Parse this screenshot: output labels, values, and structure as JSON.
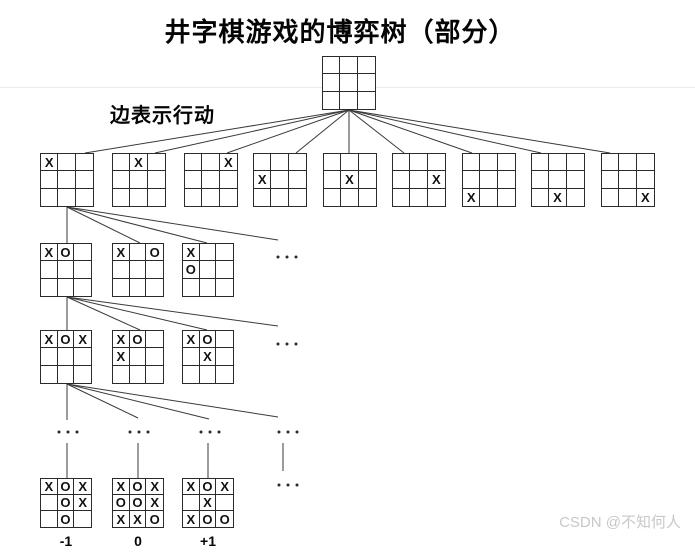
{
  "title": "井字棋游戏的博弈树（部分）",
  "edge_label": "边表示行动",
  "watermark": "CSDN @不知何人",
  "colors": {
    "background": "#ffffff",
    "line": "#3a3a3a",
    "board_border": "#2b2b2b",
    "mark_text": "#111111",
    "heading_text": "#050505",
    "watermark_text": "#c8c8c8",
    "faint_rule": "#ebebeb"
  },
  "tree": {
    "boards": [
      {
        "name": "root",
        "x": 322,
        "y": 56,
        "w": 54,
        "h": 54,
        "cells": [
          "",
          "",
          "",
          "",
          "",
          "",
          "",
          "",
          ""
        ]
      },
      {
        "name": "l1-0",
        "x": 40,
        "y": 153,
        "w": 54,
        "h": 54,
        "cells": [
          "X",
          "",
          "",
          "",
          "",
          "",
          "",
          "",
          ""
        ]
      },
      {
        "name": "l1-1",
        "x": 112,
        "y": 153,
        "w": 54,
        "h": 54,
        "cells": [
          "",
          "X",
          "",
          "",
          "",
          "",
          "",
          "",
          ""
        ]
      },
      {
        "name": "l1-2",
        "x": 184,
        "y": 153,
        "w": 54,
        "h": 54,
        "cells": [
          "",
          "",
          "X",
          "",
          "",
          "",
          "",
          "",
          ""
        ]
      },
      {
        "name": "l1-3",
        "x": 253,
        "y": 153,
        "w": 54,
        "h": 54,
        "cells": [
          "",
          "",
          "",
          "X",
          "",
          "",
          "",
          "",
          ""
        ]
      },
      {
        "name": "l1-4",
        "x": 323,
        "y": 153,
        "w": 54,
        "h": 54,
        "cells": [
          "",
          "",
          "",
          "",
          "X",
          "",
          "",
          "",
          ""
        ]
      },
      {
        "name": "l1-5",
        "x": 392,
        "y": 153,
        "w": 54,
        "h": 54,
        "cells": [
          "",
          "",
          "",
          "",
          "",
          "X",
          "",
          "",
          ""
        ]
      },
      {
        "name": "l1-6",
        "x": 462,
        "y": 153,
        "w": 54,
        "h": 54,
        "cells": [
          "",
          "",
          "",
          "",
          "",
          "",
          "X",
          "",
          ""
        ]
      },
      {
        "name": "l1-7",
        "x": 531,
        "y": 153,
        "w": 54,
        "h": 54,
        "cells": [
          "",
          "",
          "",
          "",
          "",
          "",
          "",
          "X",
          ""
        ]
      },
      {
        "name": "l1-8",
        "x": 601,
        "y": 153,
        "w": 54,
        "h": 54,
        "cells": [
          "",
          "",
          "",
          "",
          "",
          "",
          "",
          "",
          "X"
        ]
      },
      {
        "name": "l2-0",
        "x": 40,
        "y": 243,
        "w": 52,
        "h": 54,
        "cells": [
          "X",
          "O",
          "",
          "",
          "",
          "",
          "",
          "",
          ""
        ]
      },
      {
        "name": "l2-1",
        "x": 112,
        "y": 243,
        "w": 52,
        "h": 54,
        "cells": [
          "X",
          "",
          "O",
          "",
          "",
          "",
          "",
          "",
          ""
        ]
      },
      {
        "name": "l2-2",
        "x": 182,
        "y": 243,
        "w": 52,
        "h": 54,
        "cells": [
          "X",
          "",
          "",
          "O",
          "",
          "",
          "",
          "",
          ""
        ]
      },
      {
        "name": "l3-0",
        "x": 40,
        "y": 330,
        "w": 52,
        "h": 54,
        "cells": [
          "X",
          "O",
          "X",
          "",
          "",
          "",
          "",
          "",
          ""
        ]
      },
      {
        "name": "l3-1",
        "x": 112,
        "y": 330,
        "w": 52,
        "h": 54,
        "cells": [
          "X",
          "O",
          "",
          "X",
          "",
          "",
          "",
          "",
          ""
        ]
      },
      {
        "name": "l3-2",
        "x": 182,
        "y": 330,
        "w": 52,
        "h": 54,
        "cells": [
          "X",
          "O",
          "",
          "",
          "X",
          "",
          "",
          "",
          ""
        ]
      },
      {
        "name": "terminal-0",
        "x": 40,
        "y": 478,
        "w": 52,
        "h": 50,
        "cells": [
          "X",
          "O",
          "X",
          "",
          "O",
          "X",
          "",
          "O",
          ""
        ]
      },
      {
        "name": "terminal-1",
        "x": 112,
        "y": 478,
        "w": 52,
        "h": 50,
        "cells": [
          "X",
          "O",
          "X",
          "O",
          "O",
          "X",
          "X",
          "X",
          "O"
        ]
      },
      {
        "name": "terminal-2",
        "x": 182,
        "y": 478,
        "w": 52,
        "h": 50,
        "cells": [
          "X",
          "O",
          "X",
          "",
          "X",
          "",
          "X",
          "O",
          "O"
        ]
      }
    ],
    "terminal_values": [
      {
        "label": "-1",
        "cx": 66,
        "y": 533
      },
      {
        "label": "0",
        "cx": 138,
        "y": 533
      },
      {
        "label": "+1",
        "cx": 208,
        "y": 533
      }
    ],
    "ellipses": [
      {
        "cx": 287,
        "cy": 257
      },
      {
        "cx": 287,
        "cy": 344
      },
      {
        "cx": 68,
        "cy": 432
      },
      {
        "cx": 139,
        "cy": 432
      },
      {
        "cx": 210,
        "cy": 432
      },
      {
        "cx": 288,
        "cy": 432
      },
      {
        "cx": 288,
        "cy": 485
      }
    ],
    "edges": [
      [
        349,
        110,
        85,
        153
      ],
      [
        349,
        110,
        155,
        153
      ],
      [
        349,
        110,
        227,
        153
      ],
      [
        349,
        110,
        296,
        153
      ],
      [
        349,
        110,
        349,
        153
      ],
      [
        349,
        110,
        404,
        153
      ],
      [
        349,
        110,
        472,
        153
      ],
      [
        349,
        110,
        541,
        153
      ],
      [
        349,
        110,
        610,
        153
      ],
      [
        67,
        207,
        67,
        243
      ],
      [
        67,
        207,
        140,
        243
      ],
      [
        67,
        207,
        207,
        243
      ],
      [
        67,
        207,
        278,
        240
      ],
      [
        67,
        297,
        67,
        330
      ],
      [
        67,
        297,
        140,
        330
      ],
      [
        67,
        297,
        207,
        330
      ],
      [
        67,
        297,
        278,
        326
      ],
      [
        67,
        384,
        67,
        420
      ],
      [
        67,
        384,
        138,
        418
      ],
      [
        67,
        384,
        209,
        419
      ],
      [
        67,
        384,
        278,
        417
      ],
      [
        67,
        443,
        67,
        478
      ],
      [
        138,
        443,
        138,
        478
      ],
      [
        208,
        443,
        208,
        478
      ],
      [
        283,
        443,
        283,
        471
      ]
    ]
  }
}
